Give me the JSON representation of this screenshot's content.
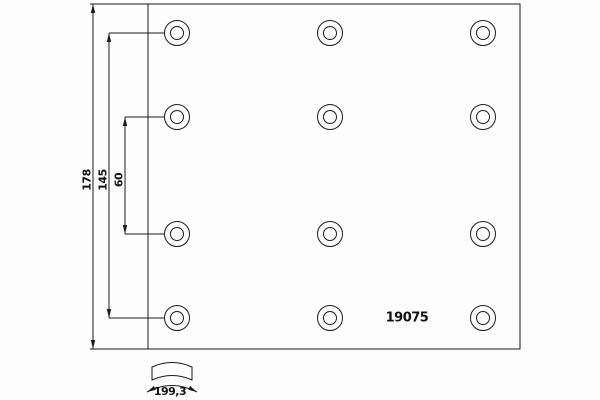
{
  "drawing": {
    "title": "brake-lining-drilling-pattern",
    "part_number": "19075",
    "dimensions": {
      "total_height": "178",
      "outer_hole_spacing": "145",
      "inner_hole_spacing": "60",
      "arc_width": "199,3"
    },
    "hole_grid": {
      "columns": 3,
      "rows": 4,
      "hole_style": "double-circle"
    },
    "colors": {
      "line": "#1c1c1c",
      "text": "#111111",
      "background": "#fdfdfd"
    }
  }
}
